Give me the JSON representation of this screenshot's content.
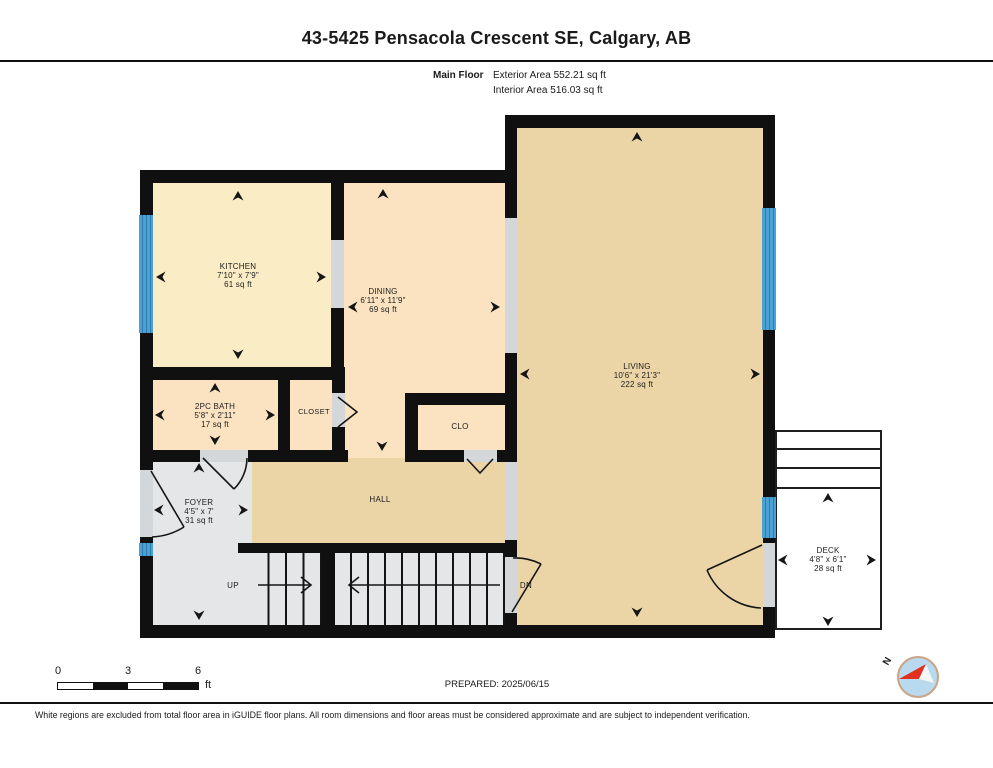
{
  "header": {
    "title": "43-5425 Pensacola Crescent SE, Calgary, AB",
    "floor_label": "Main Floor",
    "exterior_area": "Exterior Area 552.21 sq ft",
    "interior_area": "Interior Area 516.03 sq ft"
  },
  "rooms": {
    "kitchen": {
      "name": "KITCHEN",
      "dims": "7'10\" x 7'9\"",
      "area": "61 sq ft"
    },
    "dining": {
      "name": "DINING",
      "dims": "6'11\" x 11'9\"",
      "area": "69 sq ft"
    },
    "living": {
      "name": "LIVING",
      "dims": "10'6\" x 21'3\"",
      "area": "222 sq ft"
    },
    "bath": {
      "name": "2PC BATH",
      "dims": "5'8\" x 2'11\"",
      "area": "17 sq ft"
    },
    "closet": {
      "name": "CLOSET"
    },
    "clo": {
      "name": "CLO"
    },
    "foyer": {
      "name": "FOYER",
      "dims": "4'5\" x 7'",
      "area": "31 sq ft"
    },
    "hall": {
      "name": "HALL"
    },
    "deck": {
      "name": "DECK",
      "dims": "4'8\" x 6'1\"",
      "area": "28 sq ft"
    }
  },
  "stairs": {
    "up_label": "UP",
    "dn_label": "DN"
  },
  "footer": {
    "scale": {
      "tick0": "0",
      "tick3": "3",
      "tick6": "6",
      "unit": "ft"
    },
    "prepared": "PREPARED: 2025/06/15",
    "compass_label": "N",
    "disclaimer": "White regions are excluded from total floor area in iGUIDE floor plans. All room dimensions and floor areas must be considered approximate and are subject to independent verification."
  },
  "colors": {
    "wall": "#101010",
    "window_blue": "#4BA0D4",
    "opening_gray": "#D4D7DA",
    "kitchen_floor": "#FAECC5",
    "dining_floor": "#FBE3C1",
    "living_floor": "#EBD5A7",
    "foyer_floor": "#E4E6E8",
    "compass_red": "#E03020"
  }
}
